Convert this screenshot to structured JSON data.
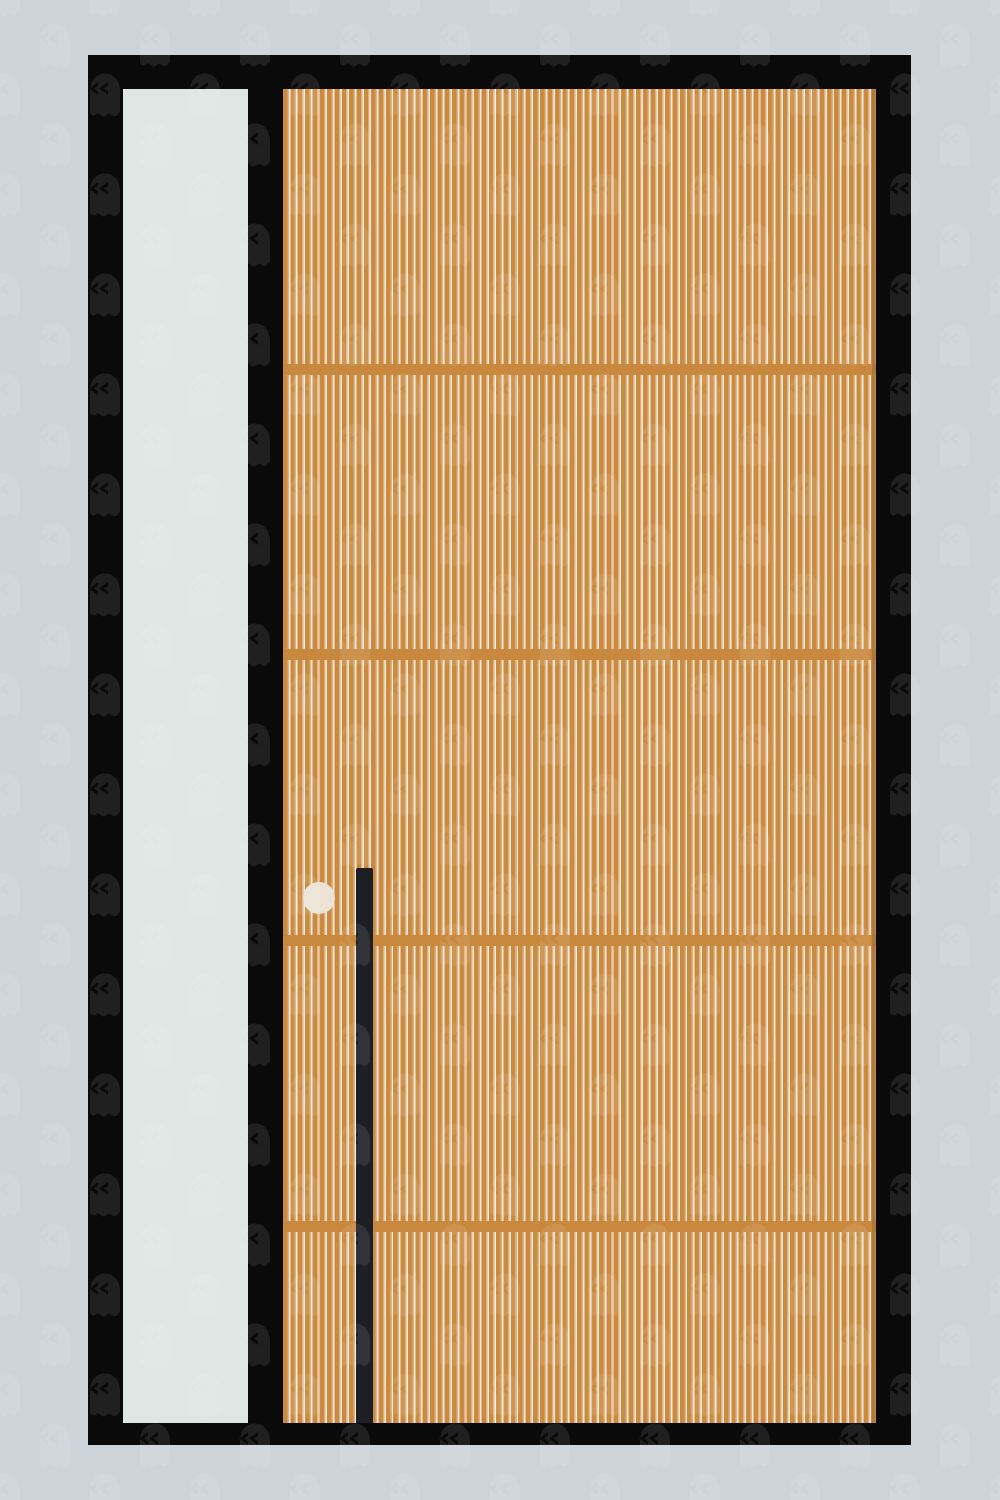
{
  "scene": {
    "description": "Flat illustration of a modern front door: black door frame on a pale blue-grey wall, tall light sidelight window panel on the left, wide door of vertical orange wood slats with four horizontal divider rails, a long black vertical pull handle and a round cream doorbell button; the whole image is covered by a faint staggered tiled ghost-emoji watermark pattern",
    "labels": {
      "scene": "front door illustration",
      "frame": "black door frame",
      "sidelight": "sidelight glass panel",
      "door": "wood slat door",
      "divider": "horizontal divider rail",
      "doorbell": "doorbell button",
      "handle": "door pull handle",
      "watermark": "ghost emoji watermark pattern"
    }
  },
  "colors": {
    "background": "#ccd3d9",
    "frame": "#0a0a0b",
    "sidelight": "#dfe6e3",
    "door_base": "#cc8a3f",
    "slat_tan": "#dcb184",
    "slat_highlight": "#f2ecdf",
    "divider": "#c8883d",
    "handle": "#1e1f25",
    "doorbell": "#ece3d4",
    "watermark": "#ffffff"
  },
  "watermark": {
    "glyph": "ghost-emoji",
    "tile_size": 100,
    "opacity": 0.09
  }
}
